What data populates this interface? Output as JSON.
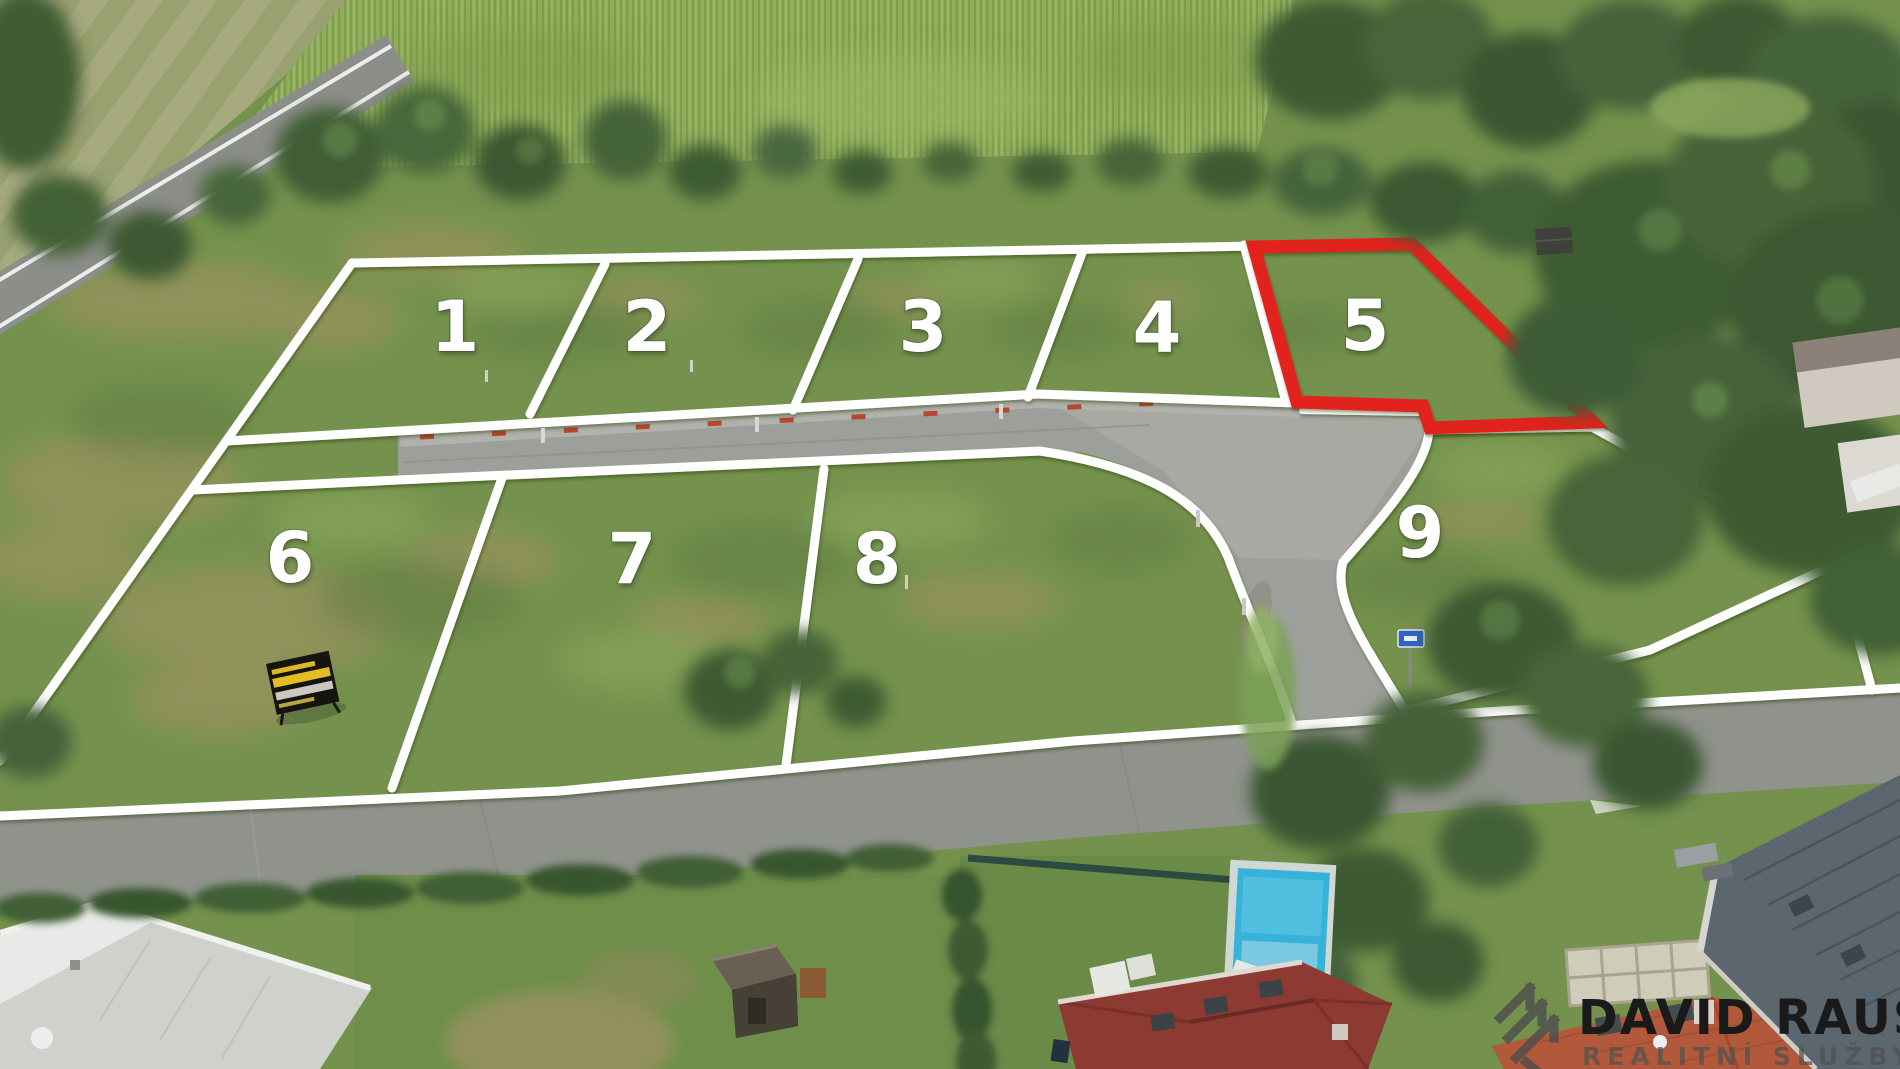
{
  "image": {
    "description": "Aerial drone photo of a development with nine grass building plots outlined in white; plot 5 is highlighted with a red outline. Cornfield and trees at top, internal access road between plot rows, street and family houses with gardens and a pool at the bottom, realtor watermark at bottom right."
  },
  "plots": [
    {
      "number": "1",
      "highlighted": false
    },
    {
      "number": "2",
      "highlighted": false
    },
    {
      "number": "3",
      "highlighted": false
    },
    {
      "number": "4",
      "highlighted": false
    },
    {
      "number": "5",
      "highlighted": true
    },
    {
      "number": "6",
      "highlighted": false
    },
    {
      "number": "7",
      "highlighted": false
    },
    {
      "number": "8",
      "highlighted": false
    },
    {
      "number": "9",
      "highlighted": false
    }
  ],
  "colors": {
    "plot_boundary": "#ffffff",
    "highlight_outline": "#e2231a",
    "plot_number_text": "#ffffff",
    "grass": "#74924d",
    "road": "#9da09a",
    "street": "#90938c"
  },
  "watermark": {
    "title": "DAVID RAUS",
    "subtitle": "REALITNÍ SLUŽBY",
    "title_color": "#1a1a1a",
    "subtitle_color": "#505050"
  },
  "signs": {
    "sale_sign": {
      "board_color": "#16140f",
      "stripe_colors": [
        "#e4bd25",
        "#ccc8bf"
      ]
    },
    "street_sign": {
      "color": "#2f62c8"
    }
  }
}
